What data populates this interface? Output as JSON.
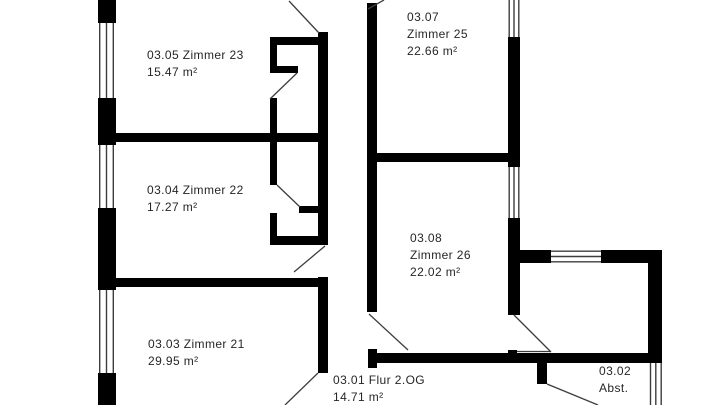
{
  "document_type": "floor-plan",
  "floor": "2.OG",
  "colors": {
    "background": "#ffffff",
    "wall": "#000000",
    "thin_line": "#3d3d3d",
    "text": "#262626"
  },
  "rooms": [
    {
      "id": "zimmer-23",
      "number": "03.05",
      "name": "Zimmer 23",
      "area": "15.47 m²",
      "lines": [
        "03.05 Zimmer 23",
        "15.47 m²"
      ]
    },
    {
      "id": "zimmer-22",
      "number": "03.04",
      "name": "Zimmer 22",
      "area": "17.27 m²",
      "lines": [
        "03.04 Zimmer 22",
        "17.27 m²"
      ]
    },
    {
      "id": "zimmer-21",
      "number": "03.03",
      "name": "Zimmer 21",
      "area": "29.95 m²",
      "lines": [
        "03.03 Zimmer 21",
        "29.95 m²"
      ]
    },
    {
      "id": "zimmer-25",
      "number": "03.07",
      "name": "Zimmer 25",
      "area": "22.66 m²",
      "lines": [
        "03.07",
        "Zimmer 25",
        "22.66 m²"
      ]
    },
    {
      "id": "zimmer-26",
      "number": "03.08",
      "name": "Zimmer 26",
      "area": "22.02 m²",
      "lines": [
        "03.08",
        "Zimmer 26",
        "22.02 m²"
      ]
    },
    {
      "id": "flur",
      "number": "03.01",
      "name": "Flur 2.OG",
      "area": "14.71 m²",
      "lines": [
        "03.01 Flur 2.OG",
        "14.71 m²"
      ]
    },
    {
      "id": "abstellraum",
      "number": "03.02",
      "name": "Abst.",
      "area": "",
      "lines": [
        "03.02",
        "Abst."
      ]
    }
  ]
}
